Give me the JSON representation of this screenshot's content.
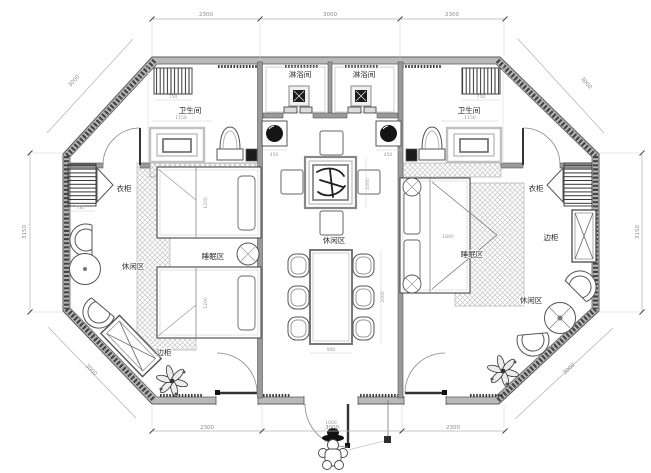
{
  "plan": {
    "labels": {
      "shower_left": "淋浴间",
      "shower_right": "淋浴间",
      "bathroom_left": "卫生间",
      "bathroom_right": "卫生间",
      "wardrobe_left": "衣柜",
      "wardrobe_right": "衣柜",
      "side_cabinet_left": "边柜",
      "side_cabinet_right": "边柜",
      "sleep_left": "睡眠区",
      "sleep_right": "睡眠区",
      "lounge_left": "休闲区",
      "lounge_center": "休闲区",
      "lounge_right": "休闲区"
    },
    "dims": {
      "top": [
        "2300",
        "3000",
        "2300"
      ],
      "bottom": [
        "2300",
        "3000",
        "2300"
      ],
      "left": "3150",
      "right": "3150",
      "diag_tl": "3000",
      "diag_tr": "3000",
      "diag_bl": "3000",
      "diag_br": "3000",
      "radiator": "750",
      "bath_width": "1150",
      "basin": "450",
      "table_side": "1000",
      "dining_width": "900",
      "dining_length": "2000",
      "entrance": "1000",
      "wardrobe_w": "750",
      "bed_double": "1800",
      "bed_single": "1200"
    }
  }
}
